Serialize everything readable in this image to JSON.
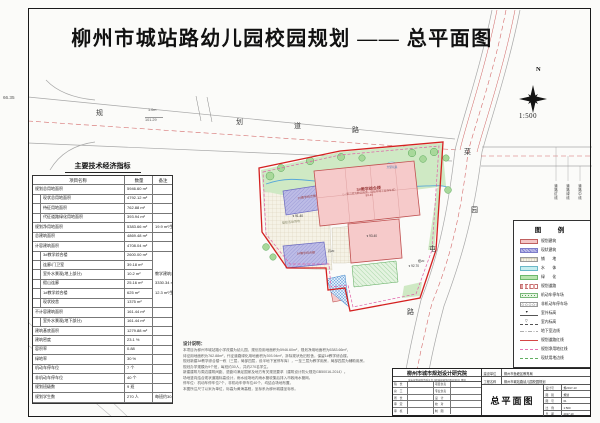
{
  "sheet": {
    "title": "柳州市城站路幼儿园校园规划 —— 总平面图",
    "scale": "1:500",
    "north": "N"
  },
  "roads": {
    "top_chars": [
      "规",
      "划",
      "道",
      "路"
    ],
    "right_chars": [
      "菜",
      "园",
      "屯",
      "路"
    ],
    "dims": {
      "left": "66.35",
      "width": "1.0m",
      "length": "101.29"
    },
    "line_labels": [
      "道路红线",
      "道路绿线",
      "道路中线"
    ]
  },
  "indicators": {
    "title": "主要技术经济指标",
    "headers": [
      "项目名称",
      "数量",
      "备注"
    ],
    "rows": [
      {
        "name": "规划总用地面积",
        "qty": "5946.60 m²",
        "note": ""
      },
      {
        "name": "现状总用地面积",
        "qty": "4792.12 m²",
        "note": "",
        "cls": "sub"
      },
      {
        "name": "待征用地面积",
        "qty": "762.88 m²",
        "note": "",
        "cls": "sub"
      },
      {
        "name": "代征道路绿化用地面积",
        "qty": "393.94 m²",
        "note": "",
        "cls": "sub"
      },
      {
        "name": "规划净用地面积",
        "qty": "5383.66 m²",
        "note": "19.9 m²/生"
      },
      {
        "name": "总建筑面积",
        "qty": "4869.48 m²",
        "note": ""
      },
      {
        "name": "计容建筑面积",
        "qty": "4708.04 m²",
        "note": ""
      },
      {
        "name": "3#教学综合楼",
        "qty": "2600.00 m²",
        "note": "",
        "cls": "sub",
        "ncls": "nb"
      },
      {
        "name": "连廊/门卫室",
        "qty": "39.18 m²",
        "note": "",
        "cls": "sub",
        "ncls": "nb"
      },
      {
        "name": "室外水景观(地上部分)",
        "qty": "10.2 m²",
        "note": "教学建筑总面积",
        "cls": "sub",
        "ncls": "nb"
      },
      {
        "name": "假山连廊",
        "qty": "25.16 m²",
        "note": "3330.34 m²",
        "cls": "sub",
        "ncls": "nb"
      },
      {
        "name": "1#教学综合楼",
        "qty": "625 m²",
        "note": "12.3 m²/生",
        "cls": "sub",
        "ncls": "nb"
      },
      {
        "name": "现状校舍",
        "qty": "1375 m²",
        "note": "",
        "cls": "sub"
      },
      {
        "name": "不计容建筑面积",
        "qty": "161.44 m²",
        "note": ""
      },
      {
        "name": "室外水景观(地下部分)",
        "qty": "161.44 m²",
        "note": "",
        "cls": "sub"
      },
      {
        "name": "建筑基底面积",
        "qty": "1279.88 m²",
        "note": ""
      },
      {
        "name": "建筑密度",
        "qty": "23.1 %",
        "note": ""
      },
      {
        "name": "容积率",
        "qty": "0.88",
        "note": ""
      },
      {
        "name": "绿地率",
        "qty": "30 %",
        "note": ""
      },
      {
        "name": "机动车停车位",
        "qty": "7 个",
        "note": ""
      },
      {
        "name": "非机动车停车位",
        "qty": "40 个",
        "note": ""
      },
      {
        "name": "规划班级数",
        "qty": "9 班",
        "note": ""
      },
      {
        "name": "规划学生数",
        "qty": "270 人",
        "note": "每班约30人"
      }
    ]
  },
  "notes": {
    "heading": "设计说明：",
    "lines": [
      "本项目为柳州市城站路小学改建为幼儿园，规划总用地面积为5946.60m²，规划净用地面积为5383.66m²，",
      "待征用地面积为762.88m²，代征道路绿化用地面积为393.94m²，拆除现状危旧校舍，保留1#教学综合楼。",
      "规划新建3#教学综合楼一栋（三层，局部四层，设半地下室停车库），一至三层为教学用房，局部四层为辅助用房。",
      "规划办学规模为9个班，每班约30人，共约270名学生。",
      "新建建筑与周边建筑间距、退距均满足国家及地方有关规范要求（建筑设计防火规范GB50016-2014）。",
      "场地竖向结合现状道路标高设计，雨水经场地内雨水管收集后排入市政雨水管网。",
      "停车位：机动车停车位7个，非机动车停车位40个，均结合场地布置。",
      "本图所注尺寸以米为单位，标高为黄海高程，坐标系为柳州城建坐标系。"
    ]
  },
  "legend": {
    "title": "图　例",
    "items": [
      {
        "label": "规划建筑",
        "sw": "sw-plan"
      },
      {
        "label": "现状建筑",
        "sw": "sw-exist"
      },
      {
        "label": "铺　　地",
        "sw": "sw-pave"
      },
      {
        "label": "水　　体",
        "sw": "sw-water"
      },
      {
        "label": "绿　　化",
        "sw": "sw-green"
      },
      {
        "label": "规划道路",
        "sw": "sw-road"
      },
      {
        "label": "机动车停车场",
        "sw": "sw-park"
      },
      {
        "label": "非机动车停车场",
        "sw": "sw-bike"
      },
      {
        "label": "室外标高",
        "sw": "sw-elev-out"
      },
      {
        "label": "室内标高",
        "sw": "sw-elev-in"
      },
      {
        "label": "地下室边线",
        "sw": "sw-basement"
      },
      {
        "label": "规划道路红线",
        "sw": "sw-redline"
      },
      {
        "label": "规划净用地红线",
        "sw": "sw-netline"
      },
      {
        "label": "现状用地边线",
        "sw": "sw-existline"
      }
    ]
  },
  "plan": {
    "b3_name": "3#教学综合楼",
    "b3_desc": "（一至三层为教学用房，设有半地下室停车库）",
    "b3_elev": "93.40",
    "b2_name": "2#教学综合楼",
    "b1_name": "1#教学综合楼",
    "pool": "大型玩具",
    "court": "塑胶活动场地",
    "elev1": "93.40",
    "elev2": "92.70",
    "elev3": "91.40",
    "tag1": "丹20",
    "tag2": "樟20"
  },
  "titleblock": {
    "institute": "柳州市城市规划设计研究院",
    "cert": "城市规划编制资质证书 [建]城规编第(081036)号 甲级",
    "staff": [
      {
        "a": "院　长",
        "b": "项目负责"
      },
      {
        "a": "总　工",
        "b": "专业负责"
      },
      {
        "a": "所　长",
        "b": "设　计"
      },
      {
        "a": "审　定",
        "b": "校　对"
      },
      {
        "a": "审　核",
        "b": "制　图"
      }
    ],
    "owner_label": "建设单位",
    "owner": "柳州市鱼峰区教育局",
    "project_label": "工程名称",
    "project": "柳州市城站路幼儿园校园规划",
    "drawing_title": "总平面图",
    "meta": [
      {
        "k": "设计号",
        "v": "规2017-13"
      },
      {
        "k": "图　别",
        "v": "规划"
      },
      {
        "k": "图　号",
        "v": "01"
      },
      {
        "k": "比　例",
        "v": "1:500"
      },
      {
        "k": "日　期",
        "v": "2017.10"
      }
    ]
  }
}
